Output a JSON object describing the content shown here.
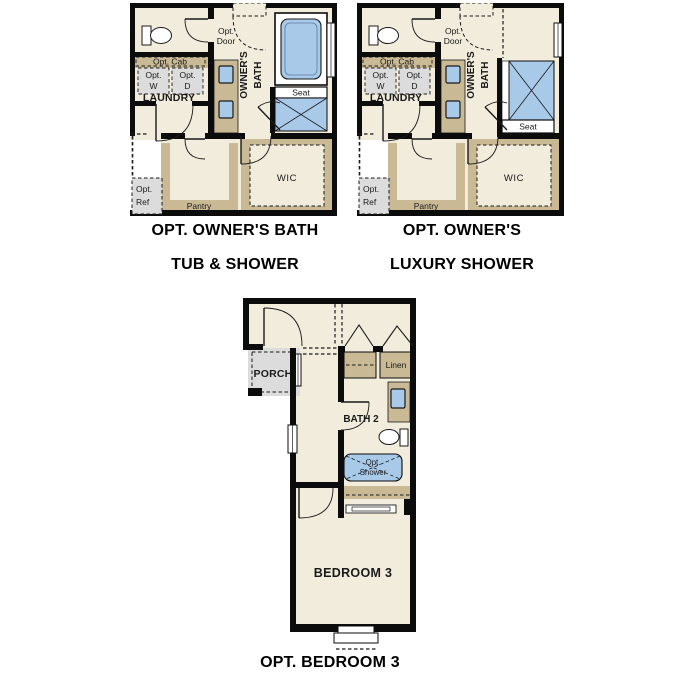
{
  "page": {
    "background": "#ffffff",
    "type": "floor-plan-options-sheet"
  },
  "colors": {
    "floor_cream": "#f2ecdc",
    "cabinet_tan": "#c9b995",
    "fixture_blue": "#a9c9e9",
    "appliance_gray": "#dcdcdc",
    "wall_black": "#0c0c0c"
  },
  "plans": {
    "owners_bath_tub_shower": {
      "caption_line1": "OPT. OWNER'S BATH",
      "caption_line2": "TUB & SHOWER",
      "labels": {
        "opt_door_line1": "Opt.",
        "opt_door_line2": "Door",
        "owners_bath_line1": "OWNER'S",
        "owners_bath_line2": "BATH",
        "opt_cab": "Opt. Cab",
        "opt_w_line1": "Opt.",
        "opt_w_line2": "W",
        "opt_d_line1": "Opt.",
        "opt_d_line2": "D",
        "laundry": "LAUNDRY",
        "seat": "Seat",
        "wic": "WIC",
        "pantry": "Pantry",
        "opt_ref_line1": "Opt.",
        "opt_ref_line2": "Ref"
      }
    },
    "owners_luxury_shower": {
      "caption_line1": "OPT. OWNER'S",
      "caption_line2": "LUXURY SHOWER",
      "labels": {
        "opt_door_line1": "Opt.",
        "opt_door_line2": "Door",
        "owners_bath_line1": "OWNER'S",
        "owners_bath_line2": "BATH",
        "opt_cab": "Opt. Cab",
        "opt_w_line1": "Opt.",
        "opt_w_line2": "W",
        "opt_d_line1": "Opt.",
        "opt_d_line2": "D",
        "laundry": "LAUNDRY",
        "seat": "Seat",
        "wic": "WIC",
        "pantry": "Pantry",
        "opt_ref_line1": "Opt.",
        "opt_ref_line2": "Ref"
      }
    },
    "bedroom3": {
      "caption": "OPT. BEDROOM 3",
      "labels": {
        "porch": "PORCH",
        "linen": "Linen",
        "bath2": "BATH 2",
        "opt_shower_line1": "Opt.",
        "opt_shower_line2": "Shower",
        "bedroom3": "BEDROOM 3"
      }
    }
  }
}
